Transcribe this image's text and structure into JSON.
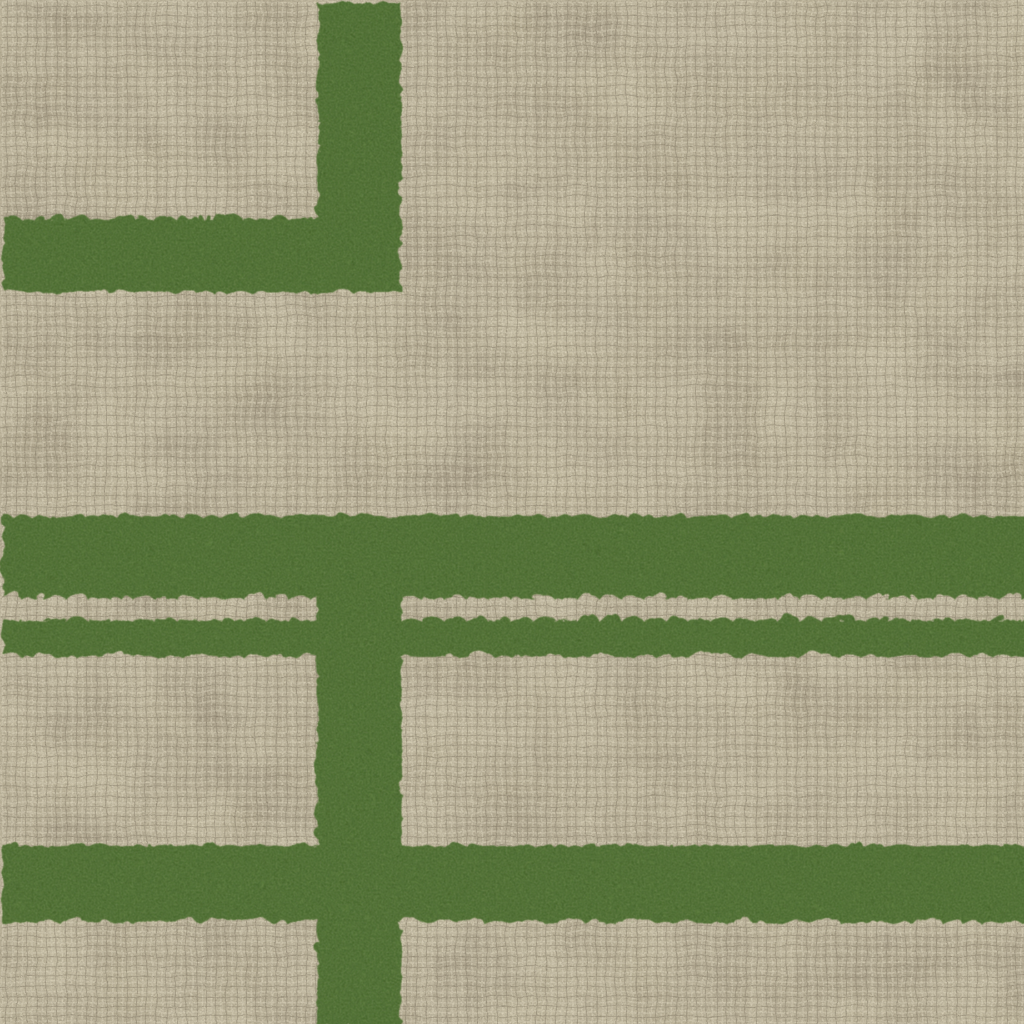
{
  "scene": {
    "name": "carpet-tile-closeup",
    "description": "Close-up photograph of a woven carpet tile: beige crosshatch linen-like textured ground with fuzzy olive-green geometric stripes. An inverted-L stripe sits in the upper left (vertical stripe from the top edge turning left into a horizontal arm). A wide green band crosses the full width at mid-height with a thin green band just below it, separated by a narrow cream gap. A vertical green stripe descends from the wide band through the thin band to the bottom edge. Another full-width green band sits near the bottom.",
    "regions": [
      {
        "name": "carpet-background",
        "label": "beige woven crosshatch texture"
      },
      {
        "name": "green-stripe-top-vertical",
        "label": "vertical green stripe at top left, x 315-398, y 0-288"
      },
      {
        "name": "green-stripe-top-horizontal-arm",
        "label": "horizontal green arm, x 0-398, y 215-288"
      },
      {
        "name": "green-band-main",
        "label": "wide horizontal green band, full width, y 513-593"
      },
      {
        "name": "green-band-thin",
        "label": "thin horizontal green band, full width, y 616-653"
      },
      {
        "name": "green-stripe-center-vertical",
        "label": "vertical green stripe, x 314-398, y 593 to bottom edge"
      },
      {
        "name": "green-band-bottom",
        "label": "horizontal green band, full width, y 842-919"
      }
    ]
  },
  "colors": {
    "beige_base": "#b3a98e",
    "beige_dark_patch": "#8c8170",
    "beige_light_patch": "#d8d0b6",
    "thread_light": "#ded6bf",
    "thread_dark": "#7a6f5d",
    "green_base": "#527436",
    "green_dark": "#35511f",
    "green_light": "#7f9b58",
    "grain_light": "#e8e1ca",
    "grain_dark": "#57503f"
  }
}
